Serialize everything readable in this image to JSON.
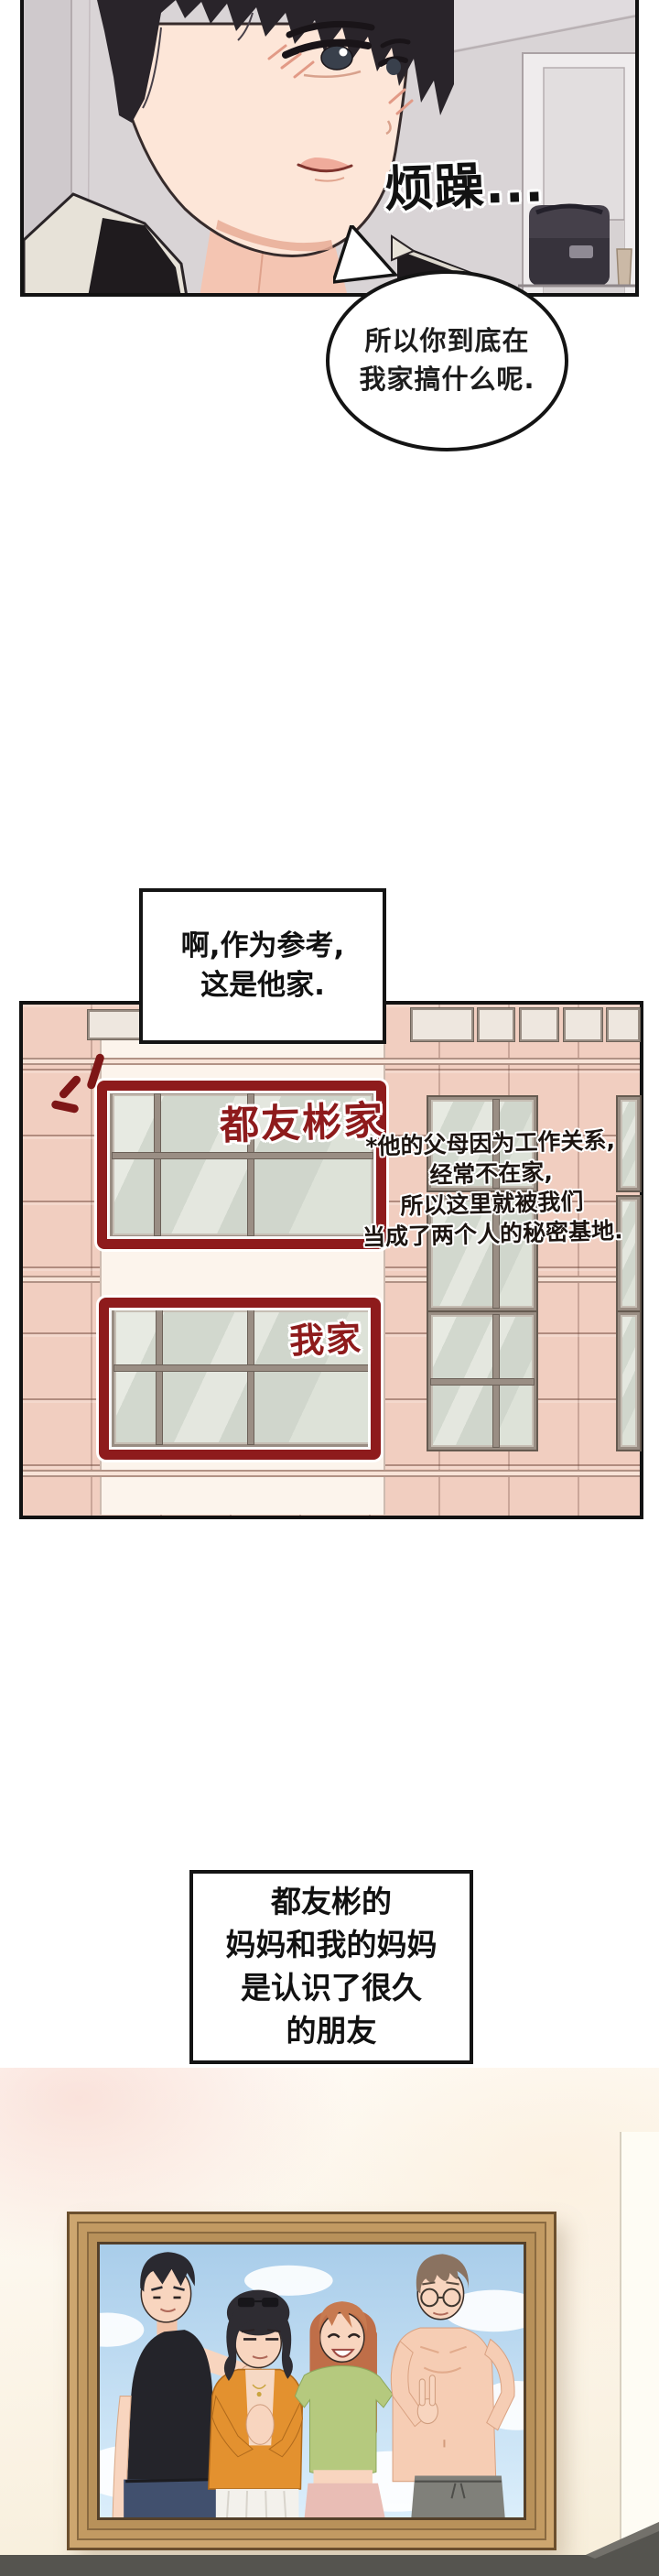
{
  "comic": {
    "panel_annoyed": {
      "sfx": "烦躁...",
      "speech": {
        "line1": "所以你到底在",
        "line2": "我家搞什么呢."
      }
    },
    "caption_reference": {
      "line1": "啊,作为参考,",
      "line2": "这是他家."
    },
    "building": {
      "label_his_home": "都友彬家",
      "label_my_home": "我家",
      "footnote": {
        "line1": "*他的父母因为工作关系,",
        "line2": "经常不在家,",
        "line3": "所以这里就被我们",
        "line4": "当成了两个人的秘密基地."
      }
    },
    "caption_moms": {
      "line1": "都友彬的",
      "line2": "妈妈和我的妈妈",
      "line3": "是认识了很久",
      "line4": "的朋友"
    },
    "colors": {
      "marker_red": "#8e1b1c",
      "tile_salmon": "#f1cec0",
      "window_glass": "#d8ddd4",
      "frame_wood": "#c79f69",
      "sky_blue": "#aecfe9",
      "floor_shadow_gray": "#55544f"
    }
  }
}
